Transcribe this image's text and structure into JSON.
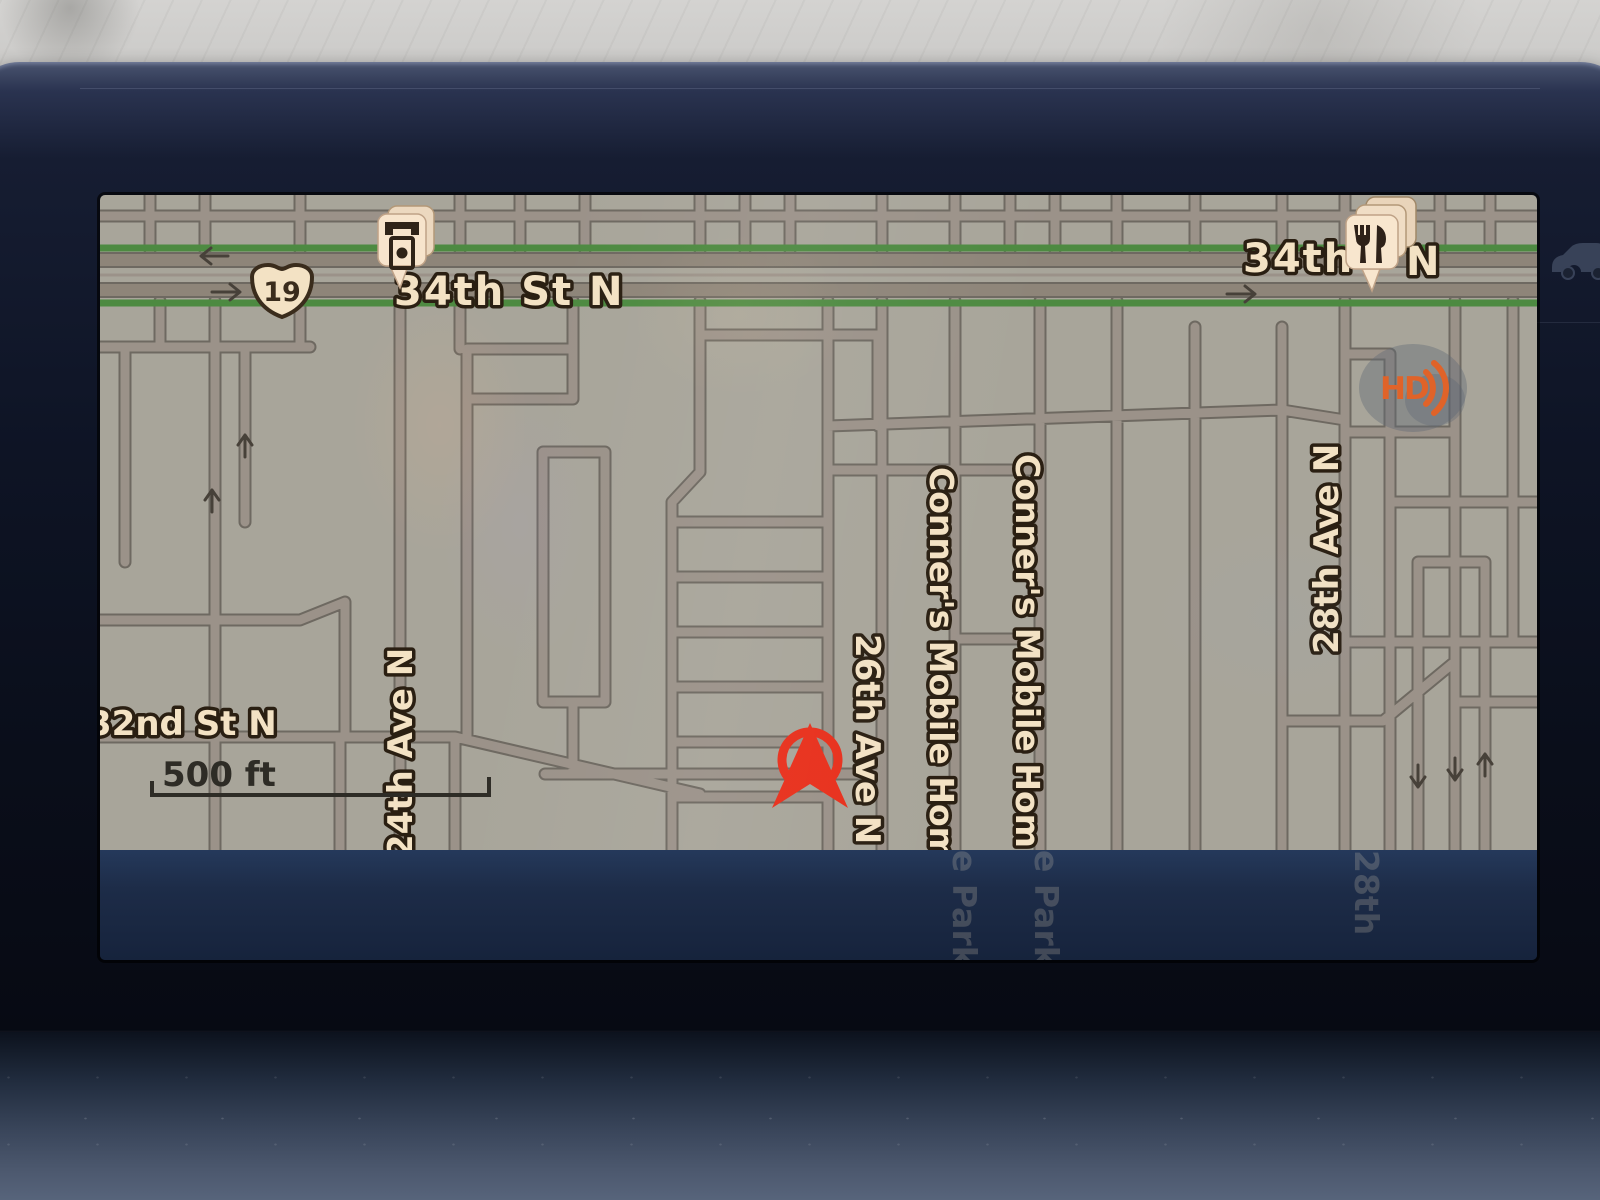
{
  "screen": {
    "type": "in-dash navigation map display"
  },
  "map": {
    "streets": {
      "main_left": "34th St N",
      "main_right": "34th",
      "main_right_n": "N",
      "cross_left": "32nd St N",
      "ave24": "24th Ave N",
      "ave26": "26th Ave N",
      "ave28": "28th Ave N",
      "conners_a": "Conner's Mobile Hom",
      "conners_b": "Conner's Mobile Hom"
    },
    "ghost_labels": {
      "a": "e Park",
      "b": "e Park",
      "c": "28th"
    },
    "route_shield": {
      "number": "19"
    },
    "scale": {
      "label": "500 ft"
    },
    "hd_icon": {
      "label": "HD"
    },
    "poi": {
      "atm": "atm-pin",
      "restaurant": "restaurant-pin"
    },
    "colors": {
      "map_bg": "#a8a59a",
      "road": "#9b9289",
      "road_casing": "#6e6961",
      "highway_green": "#4d8a41",
      "label_cream": "#f3e2c4",
      "marker_red": "#e8301c",
      "hd_orange": "#e06329",
      "screen_band": "#1d2c48",
      "bezel": "#0e1424"
    }
  }
}
